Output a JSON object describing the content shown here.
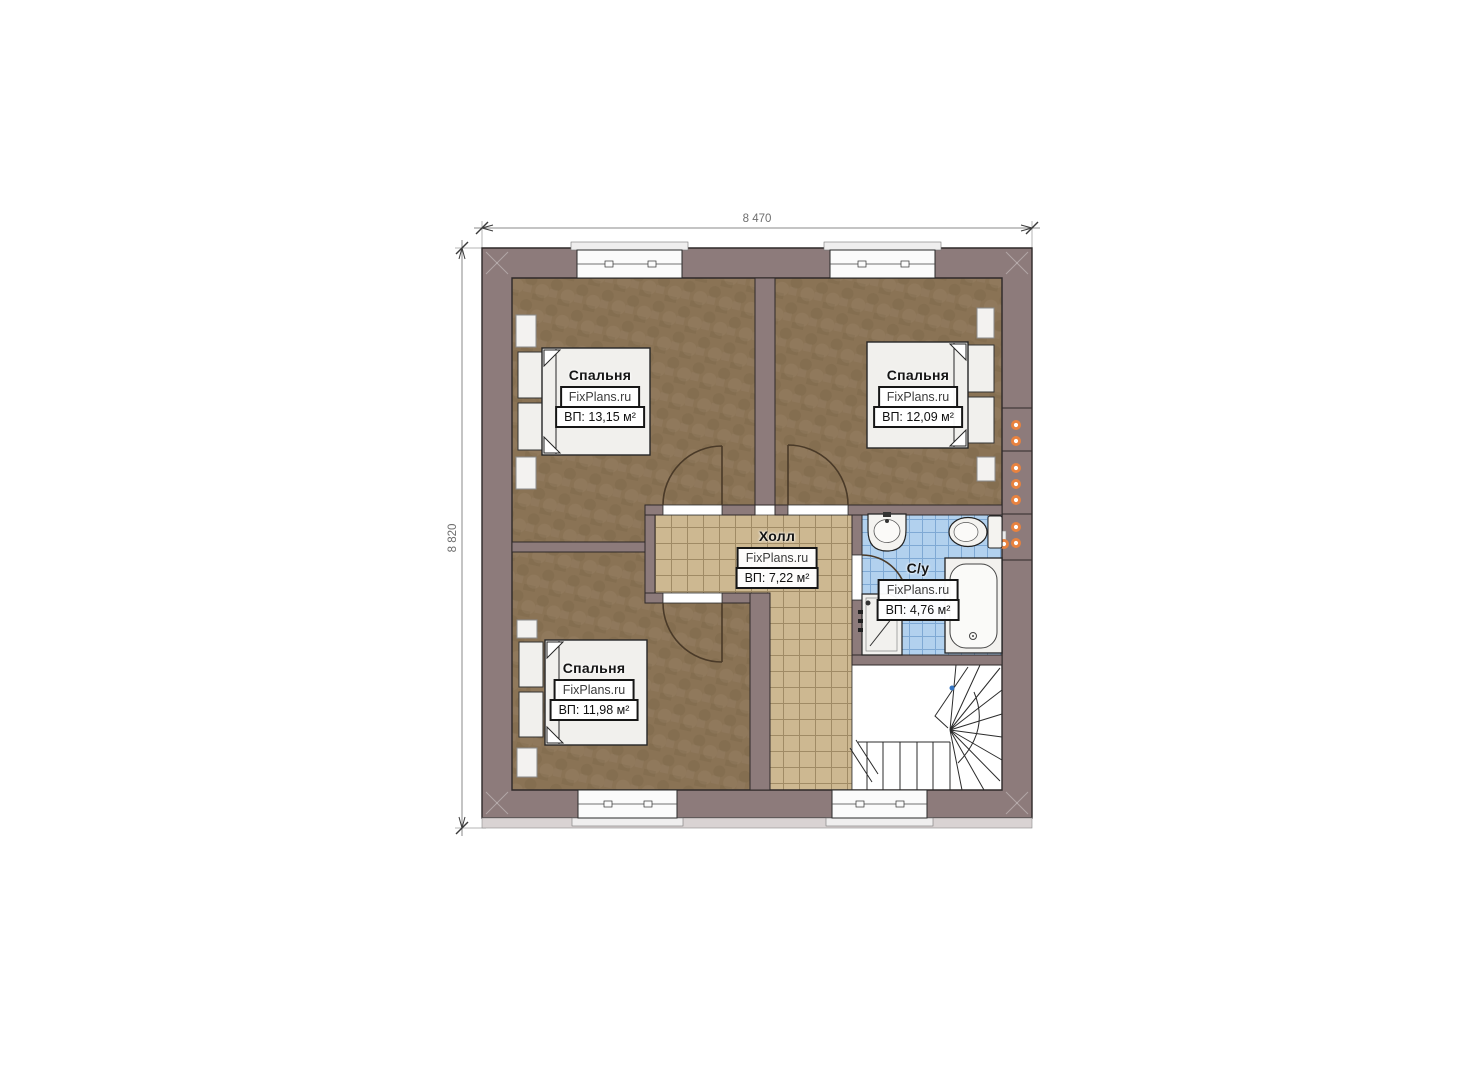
{
  "plan": {
    "dimensions": {
      "width_label": "8 470",
      "height_label": "8 820"
    },
    "watermark": "FixPlans.ru",
    "rooms": [
      {
        "id": "bedroom-top-left",
        "name": "Спальня",
        "area": "ВП: 13,15 м²"
      },
      {
        "id": "bedroom-top-right",
        "name": "Спальня",
        "area": "ВП: 12,09 м²"
      },
      {
        "id": "bedroom-bottom-left",
        "name": "Спальня",
        "area": "ВП: 11,98 м²"
      },
      {
        "id": "hall",
        "name": "Холл",
        "area": "ВП: 7,22 м²"
      },
      {
        "id": "bathroom",
        "name": "С/у",
        "area": "ВП: 4,76 м²"
      }
    ],
    "colors": {
      "wall": "#8d7b7b",
      "bedroom_floor": "#8a7355",
      "hall_tile": "#cdb891",
      "bath_tile": "#b2d1ee",
      "vent_dot": "#e8823f",
      "stairs": "#ffffff"
    }
  }
}
